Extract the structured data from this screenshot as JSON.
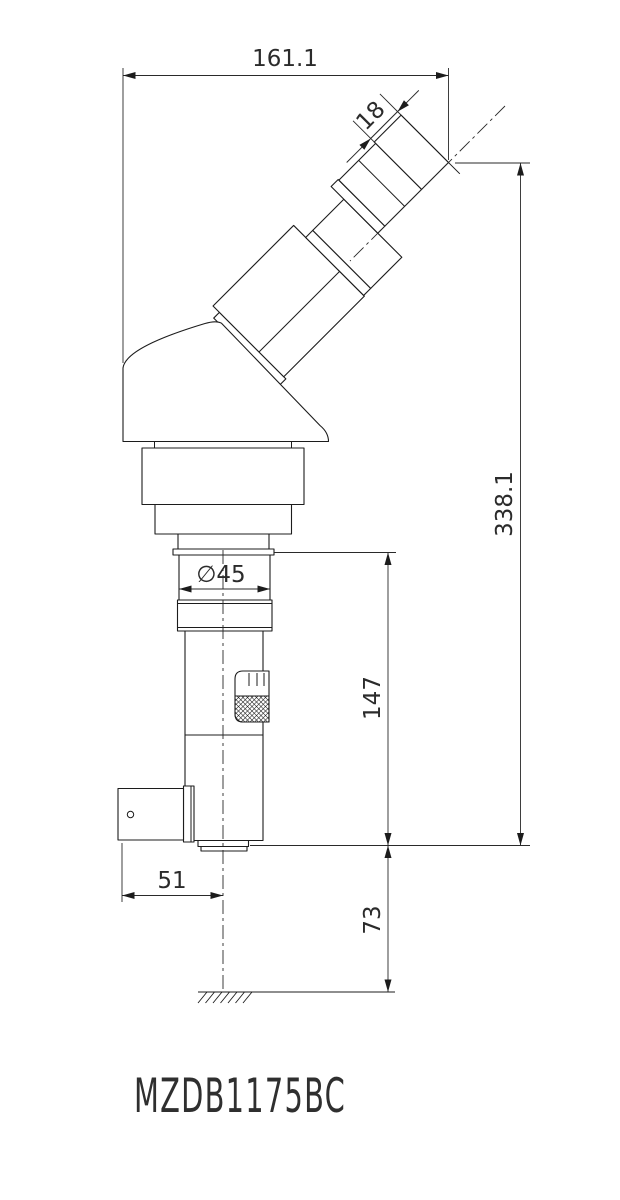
{
  "title": "MZDB1175BC",
  "dims": {
    "overall_width": "161.1",
    "eyepiece_length": "18",
    "overall_height": "338.1",
    "body_diameter": "∅45",
    "column_height": "147",
    "bracket_offset": "51",
    "working_distance": "73"
  },
  "colors": {
    "line": "#1c1c1c",
    "text": "#2b2b2b"
  }
}
